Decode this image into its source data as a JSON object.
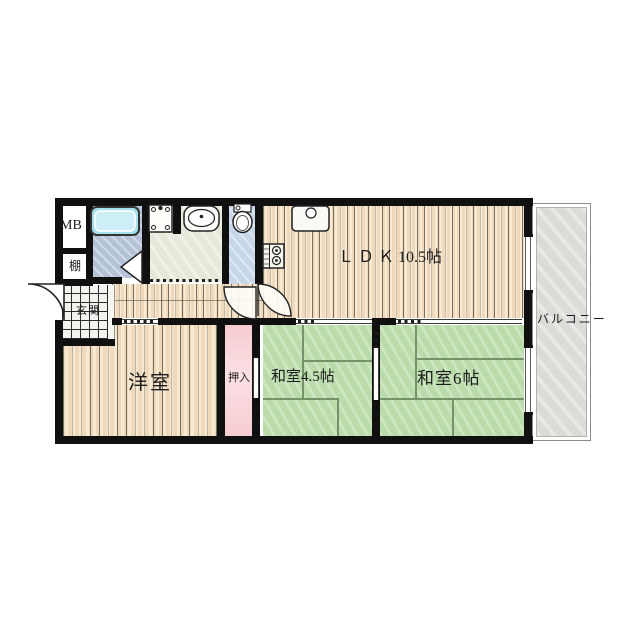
{
  "rooms": {
    "ldk": {
      "label": "Ｌ Ｄ Ｋ 10.5帖"
    },
    "japanese_room_45": {
      "label": "和室4.5帖"
    },
    "japanese_room_6": {
      "label": "和室6帖"
    },
    "western_room": {
      "label": "洋室"
    },
    "closet": {
      "label": "押入"
    },
    "entrance": {
      "label": "玄関"
    },
    "balcony": {
      "label": "バルコニー"
    },
    "meter_box": {
      "label": "MB"
    },
    "shelf": {
      "label": "棚"
    }
  },
  "icons": [
    "bathtub-icon",
    "washing-machine-icon",
    "washbasin-icon",
    "toilet-icon",
    "kitchen-sink-icon",
    "stove-icon",
    "entry-door-arc",
    "toilet-door-arc",
    "ldk-door-arc",
    "bathroom-folding-door-icon"
  ],
  "colors": {
    "wall": "#101010",
    "wood_floor": "#efd9ba",
    "tatami": "#badcaa",
    "closet_pink": "#f6ccd1",
    "bathroom_floor": "#b4c2d7",
    "toilet_floor": "#c7d6e9",
    "washroom_floor": "#e6e9d9",
    "bathtub_cyan": "#a5e0ee",
    "entrance_tile": "#f4f2ee",
    "balcony_gray": "#dcdbd7"
  }
}
